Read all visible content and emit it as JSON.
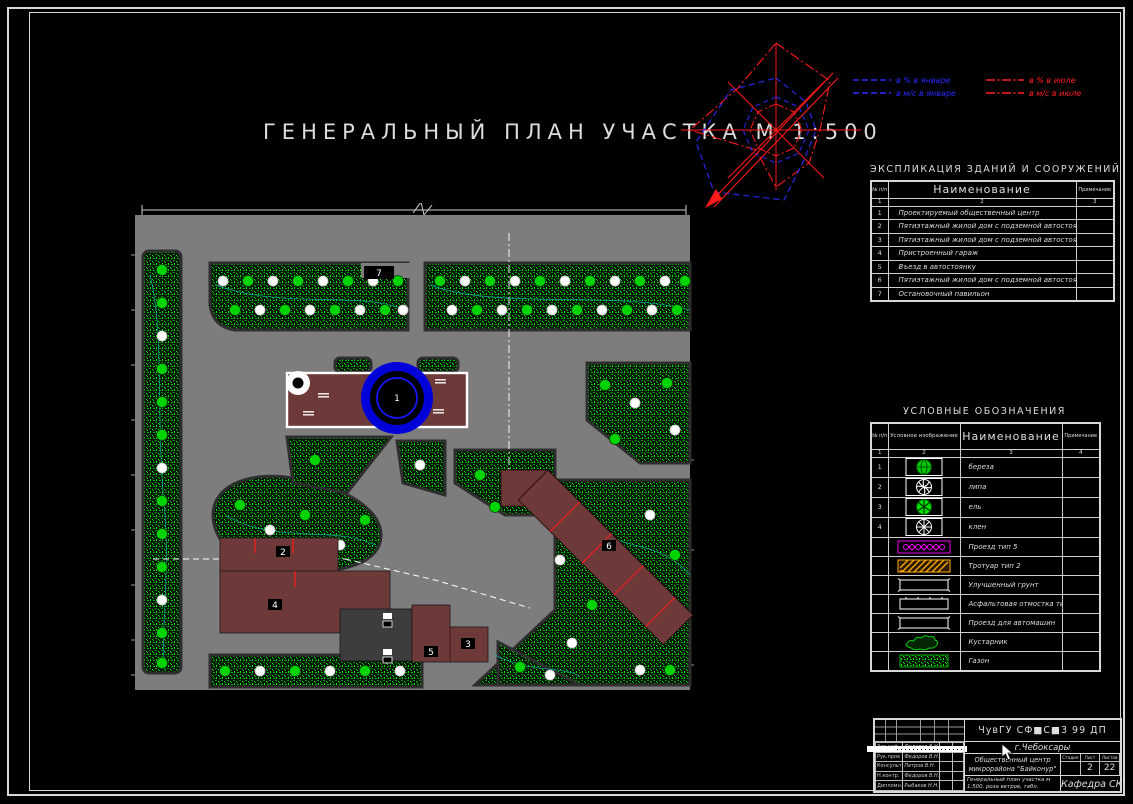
{
  "sheet": {
    "title": "ГЕНЕРАЛЬНЫЙ ПЛАН УЧАСТКА М 1:500"
  },
  "wind_rose": {
    "legend": [
      {
        "color": "#2a2aff",
        "style": "dashed",
        "label": "в % в январе"
      },
      {
        "color": "#2a2aff",
        "style": "dashed",
        "label": "в м/с в январе"
      },
      {
        "color": "#ff2020",
        "style": "dashdot",
        "label": "в % в июле"
      },
      {
        "color": "#ff2020",
        "style": "dashdot",
        "label": "в м/с в июле"
      }
    ]
  },
  "explication": {
    "title": "ЭКСПЛИКАЦИЯ ЗДАНИЙ И СООРУЖЕНИЙ",
    "columns": [
      "№ п/п",
      "Наименование",
      "Примечание"
    ],
    "col_numbers": [
      "1",
      "2",
      "3"
    ],
    "rows": [
      {
        "num": "1",
        "name": "Проектируемый общественный центр",
        "note": ""
      },
      {
        "num": "2",
        "name": "Пятиэтажный жилой дом с подземной автостоянкой",
        "note": ""
      },
      {
        "num": "3",
        "name": "Пятиэтажный жилой дом с подземной автостоянкой",
        "note": ""
      },
      {
        "num": "4",
        "name": "Пристроенный гараж",
        "note": ""
      },
      {
        "num": "5",
        "name": "Въезд в автостоянку",
        "note": ""
      },
      {
        "num": "6",
        "name": "Пятиэтажный жилой дом с подземной автостоянкой",
        "note": ""
      },
      {
        "num": "7",
        "name": "Остановочный павильон",
        "note": ""
      }
    ]
  },
  "legend_table": {
    "title": "УСЛОВНЫЕ ОБОЗНАЧЕНИЯ",
    "columns": [
      "№ п/п",
      "Условное изображение",
      "Наименование",
      "Примечание"
    ],
    "col_numbers": [
      "1",
      "2",
      "3",
      "4"
    ],
    "rows": [
      {
        "num": "1",
        "symbol": "birch-tree-symbol",
        "name": "береза"
      },
      {
        "num": "2",
        "symbol": "linden-tree-symbol",
        "name": "липа"
      },
      {
        "num": "3",
        "symbol": "spruce-tree-symbol",
        "name": "ель"
      },
      {
        "num": "4",
        "symbol": "maple-tree-symbol",
        "name": "клен"
      },
      {
        "num": "",
        "symbol": "driveway-type5-hatch",
        "name": "Проезд тип 5"
      },
      {
        "num": "",
        "symbol": "sidewalk-type2-hatch",
        "name": "Тротуар тип 2"
      },
      {
        "num": "",
        "symbol": "improved-soil-outline",
        "name": "Улучшенный грунт"
      },
      {
        "num": "",
        "symbol": "asphalt-apron-outline",
        "name": "Асфальтовая отмостка тип 2"
      },
      {
        "num": "",
        "symbol": "car-driveway-outline",
        "name": "Проезд для автомашин"
      },
      {
        "num": "",
        "symbol": "shrub-symbol",
        "name": "Кустарник"
      },
      {
        "num": "",
        "symbol": "lawn-symbol",
        "name": "Газон"
      }
    ]
  },
  "title_block": {
    "org": "ЧувГУ СФ■С■3 99 ДП",
    "city": "г.Чебоксары",
    "project": "Общественный центр микрорайона \"Байконур\"",
    "stage_label": "Стадия",
    "sheet_label": "Лист",
    "sheets_label": "Листов",
    "stage": "",
    "sheet": "2",
    "sheets": "22",
    "drawing_title": "Генеральный план участка м 1:500, роза ветров, табл.",
    "department": "Кафедра СК",
    "signature_rows": [
      {
        "role": "Зав.каф.",
        "name": "Федоров В.Н."
      },
      {
        "role": "Рук.прое",
        "name": "Федоров В.Н."
      },
      {
        "role": "Консульт",
        "name": "Петров В.Н."
      },
      {
        "role": "Н.контр.",
        "name": "Федоров В.Н."
      },
      {
        "role": "Дипломн.",
        "name": "Рыбаков Н.Н."
      }
    ]
  },
  "plan": {
    "building_labels": [
      "1",
      "2",
      "3",
      "4",
      "5",
      "6",
      "7"
    ],
    "colors": {
      "paving": "#7d7d7d",
      "building": "#6d3939",
      "lawn_green": "#00d400",
      "fountain_blue": "#0000d9",
      "section_red": "#ff1a1a"
    }
  }
}
